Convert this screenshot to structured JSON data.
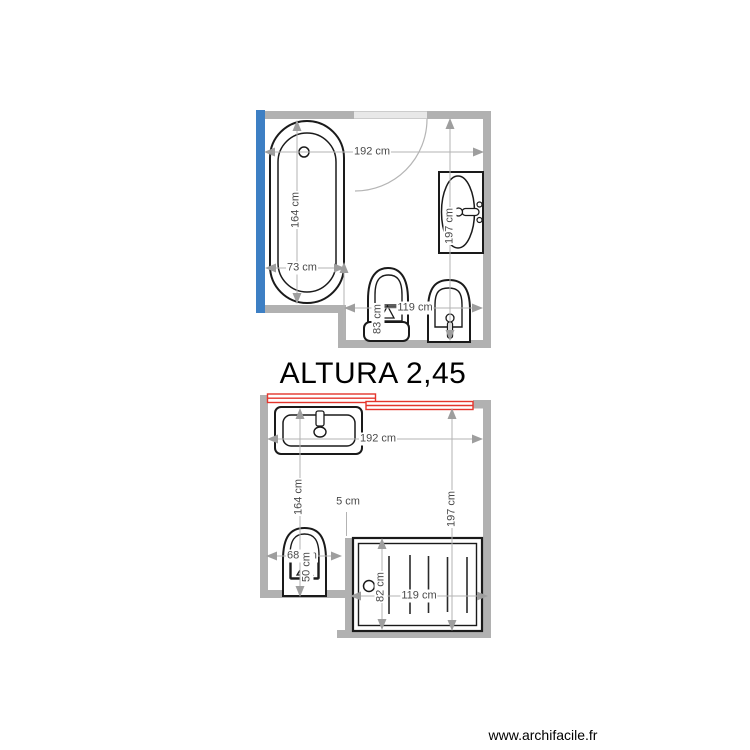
{
  "annotation": {
    "altura": "ALTURA 2,45"
  },
  "footer": {
    "watermark": "www.archifacile.fr"
  },
  "colors": {
    "wall": "#b1b1b1",
    "door_opening": "#e8e8e8",
    "blue_wall": "#3d7fc4",
    "red_door": "#e4352c",
    "dim_line": "#b3b3b3",
    "dim_arrow": "#9e9e9e",
    "dim_text": "#4a4a4a",
    "fixture_stroke": "#1a1a1a"
  },
  "top_plan": {
    "fixtures": [
      "bathtub",
      "door",
      "washbasin",
      "toilet",
      "bidet"
    ],
    "dims": {
      "room_width": "192 cm",
      "tub_length": "164 cm",
      "tub_width": "73 cm",
      "room_depth": "197 cm",
      "fixtures_width": "119 cm",
      "toilet_depth": "83 cm"
    }
  },
  "bottom_plan": {
    "fixtures": [
      "sliding-door",
      "vanity-sink",
      "toilet",
      "shower"
    ],
    "dims": {
      "room_width": "192 cm",
      "left_length": "164 cm",
      "gap": "5 cm",
      "toilet_width": "68 cm",
      "toilet_depth": "50 cm",
      "room_depth": "197 cm",
      "shower_width": "119 cm",
      "shower_depth": "82 cm"
    }
  }
}
